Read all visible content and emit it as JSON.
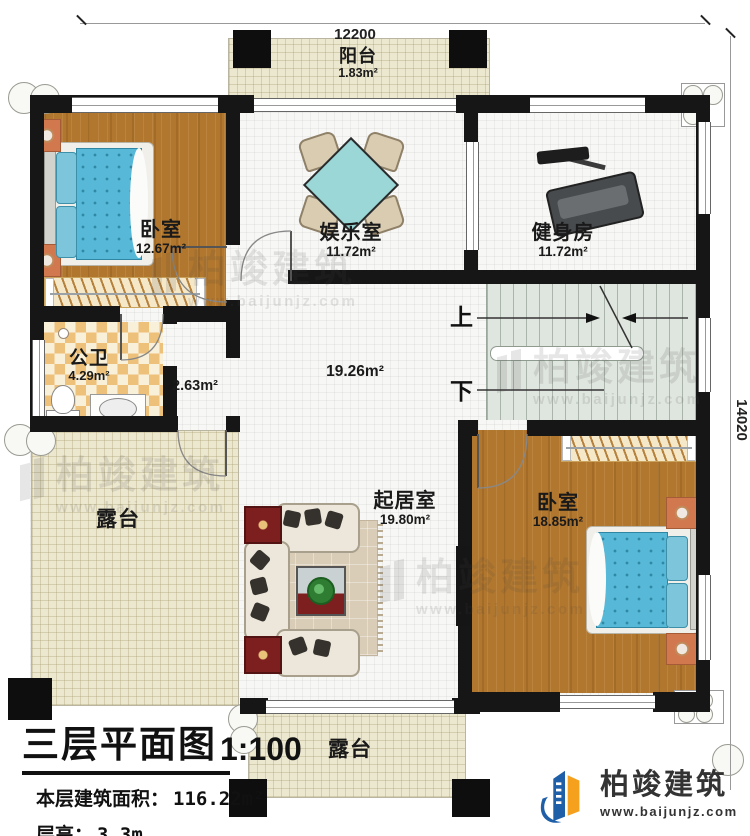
{
  "plan": {
    "dims": {
      "width_mm": "12200",
      "height_mm": "14020"
    },
    "rooms": {
      "balcony": {
        "name": "阳台",
        "area": "1.83m²"
      },
      "bedroom_top": {
        "name": "卧室",
        "area": "12.67m²"
      },
      "recreation": {
        "name": "娱乐室",
        "area": "11.72m²"
      },
      "gym": {
        "name": "健身房",
        "area": "11.72m²"
      },
      "bathroom": {
        "name": "公卫",
        "area": "4.29m²"
      },
      "hallway": {
        "area": "2.63m²"
      },
      "hall": {
        "area": "19.26m²"
      },
      "living": {
        "name": "起居室",
        "area": "19.80m²"
      },
      "bedroom_bottom": {
        "name": "卧室",
        "area": "18.85m²"
      },
      "terrace_left": {
        "name": "露台"
      },
      "terrace_bottom": {
        "name": "露台"
      }
    },
    "stairs": {
      "up": "上",
      "down": "下"
    }
  },
  "title_block": {
    "title": "三层平面图",
    "scale": "1:100",
    "area_label": "本层建筑面积：",
    "area_value": "116.22m²",
    "floor_height_label": "层高：",
    "floor_height_value": "3.3m"
  },
  "brand": {
    "name": "柏竣建筑",
    "url": "www.baijunjz.com",
    "blue": "#1e5fa8",
    "orange": "#f5a11d"
  },
  "watermark": {
    "name": "柏竣建筑",
    "url": "www.baijunjz.com"
  }
}
